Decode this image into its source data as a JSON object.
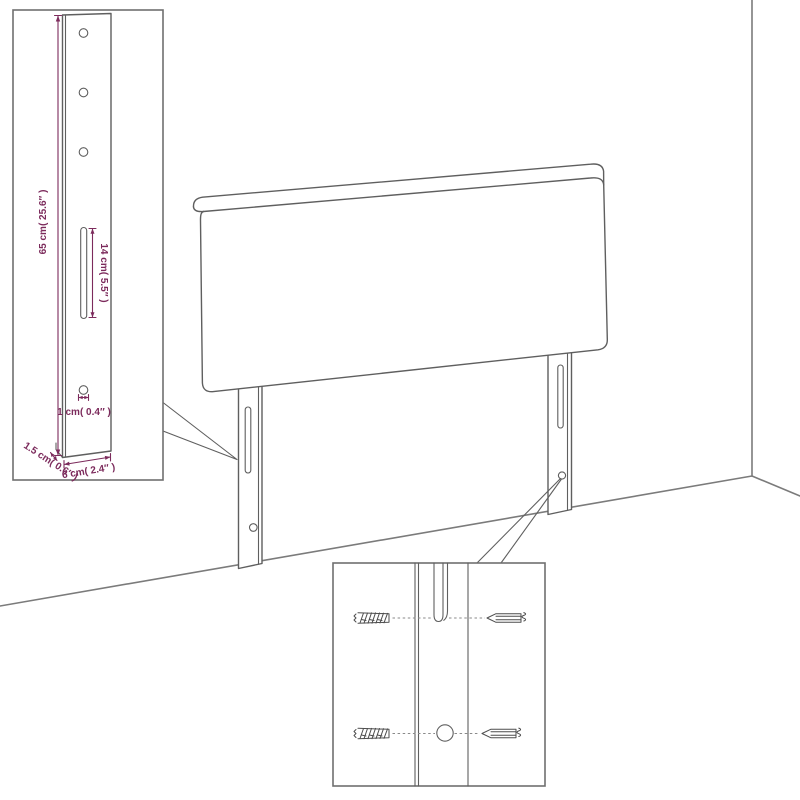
{
  "page": {
    "background": "#ffffff"
  },
  "colors": {
    "line": "#5f5f5f",
    "wall": "#7b7b7b",
    "box_border": "#6f6f6f",
    "dimension": "#7c2b5c",
    "screw": "#4d4d4d",
    "dash": "#8a8a8a"
  },
  "dimensions": {
    "height_label": "65 cm( 25.6″ )",
    "slot_label": "14 cm( 5.5″ )",
    "hole_label": "1 cm( 0.4″ )",
    "thickness_label": "1.5 cm( 0.6″ )",
    "width_label": "6 cm( 2.4″ )"
  }
}
